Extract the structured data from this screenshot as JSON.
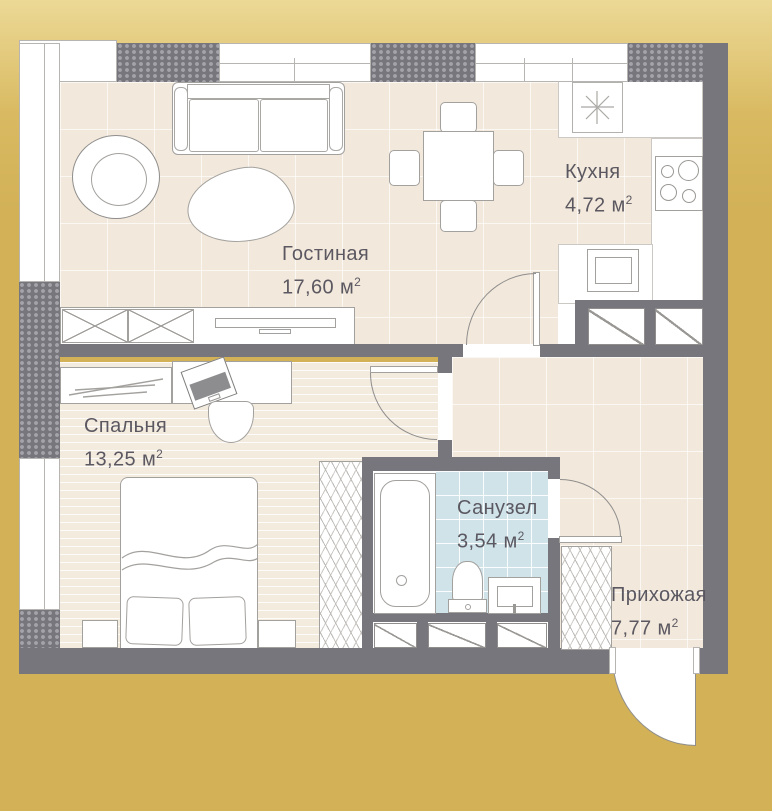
{
  "rooms": [
    {
      "name": "Гостиная",
      "area": "17,60 м",
      "sup": "2"
    },
    {
      "name": "Кухня",
      "area": "4,72 м",
      "sup": "2"
    },
    {
      "name": "Спальня",
      "area": "13,25 м",
      "sup": "2"
    },
    {
      "name": "Санузел",
      "area": "3,54 м",
      "sup": "2"
    },
    {
      "name": "Прихожая",
      "area": "7,77 м",
      "sup": "2"
    }
  ],
  "colors": {
    "background_gold": "#d2b157",
    "wall_gray": "#77767c",
    "floor_beige": "#f2e8db",
    "bathroom_blue": "#cfe3e9",
    "label_text": "#5b5861"
  },
  "icons": {
    "vent": "vent-asterisk"
  }
}
